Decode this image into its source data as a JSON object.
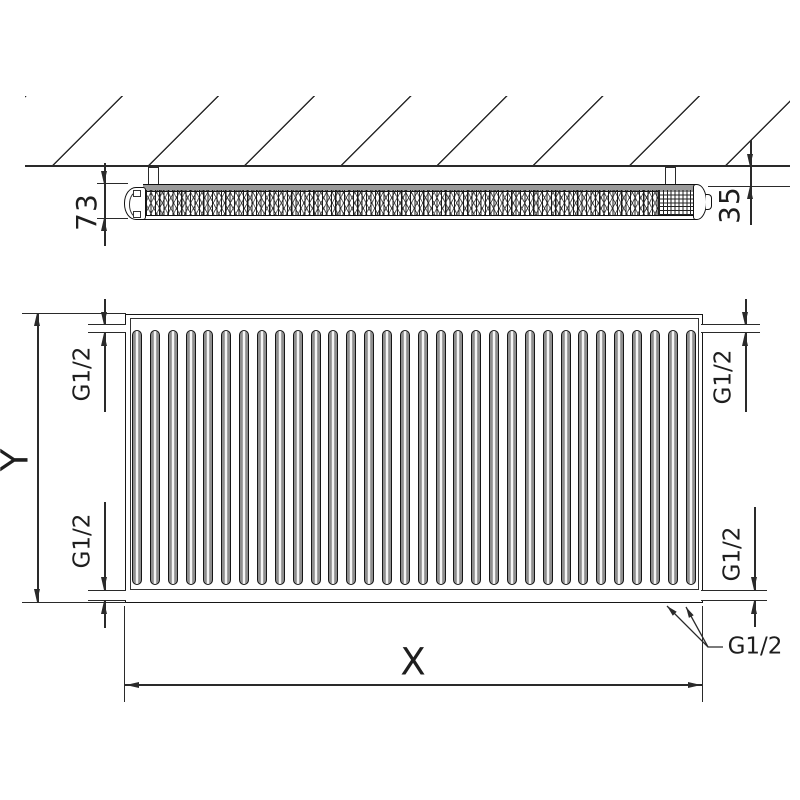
{
  "side_view": {
    "depth_dim": "73",
    "wall_gap_dim": "35"
  },
  "front_view": {
    "height_dim": "Y",
    "width_dim": "X",
    "conn_top_left": "G1/2",
    "conn_bottom_left": "G1/2",
    "conn_top_right": "G1/2",
    "conn_bottom_right": "G1/2",
    "conn_callout": "G1/2",
    "channel_count": 32
  },
  "colors": {
    "ink": "#1e1e1e",
    "dim_line": "#2a2a2a",
    "rib_gray": "#8e8e8e",
    "band_gray": "#9a9a9a",
    "background": "#ffffff"
  }
}
